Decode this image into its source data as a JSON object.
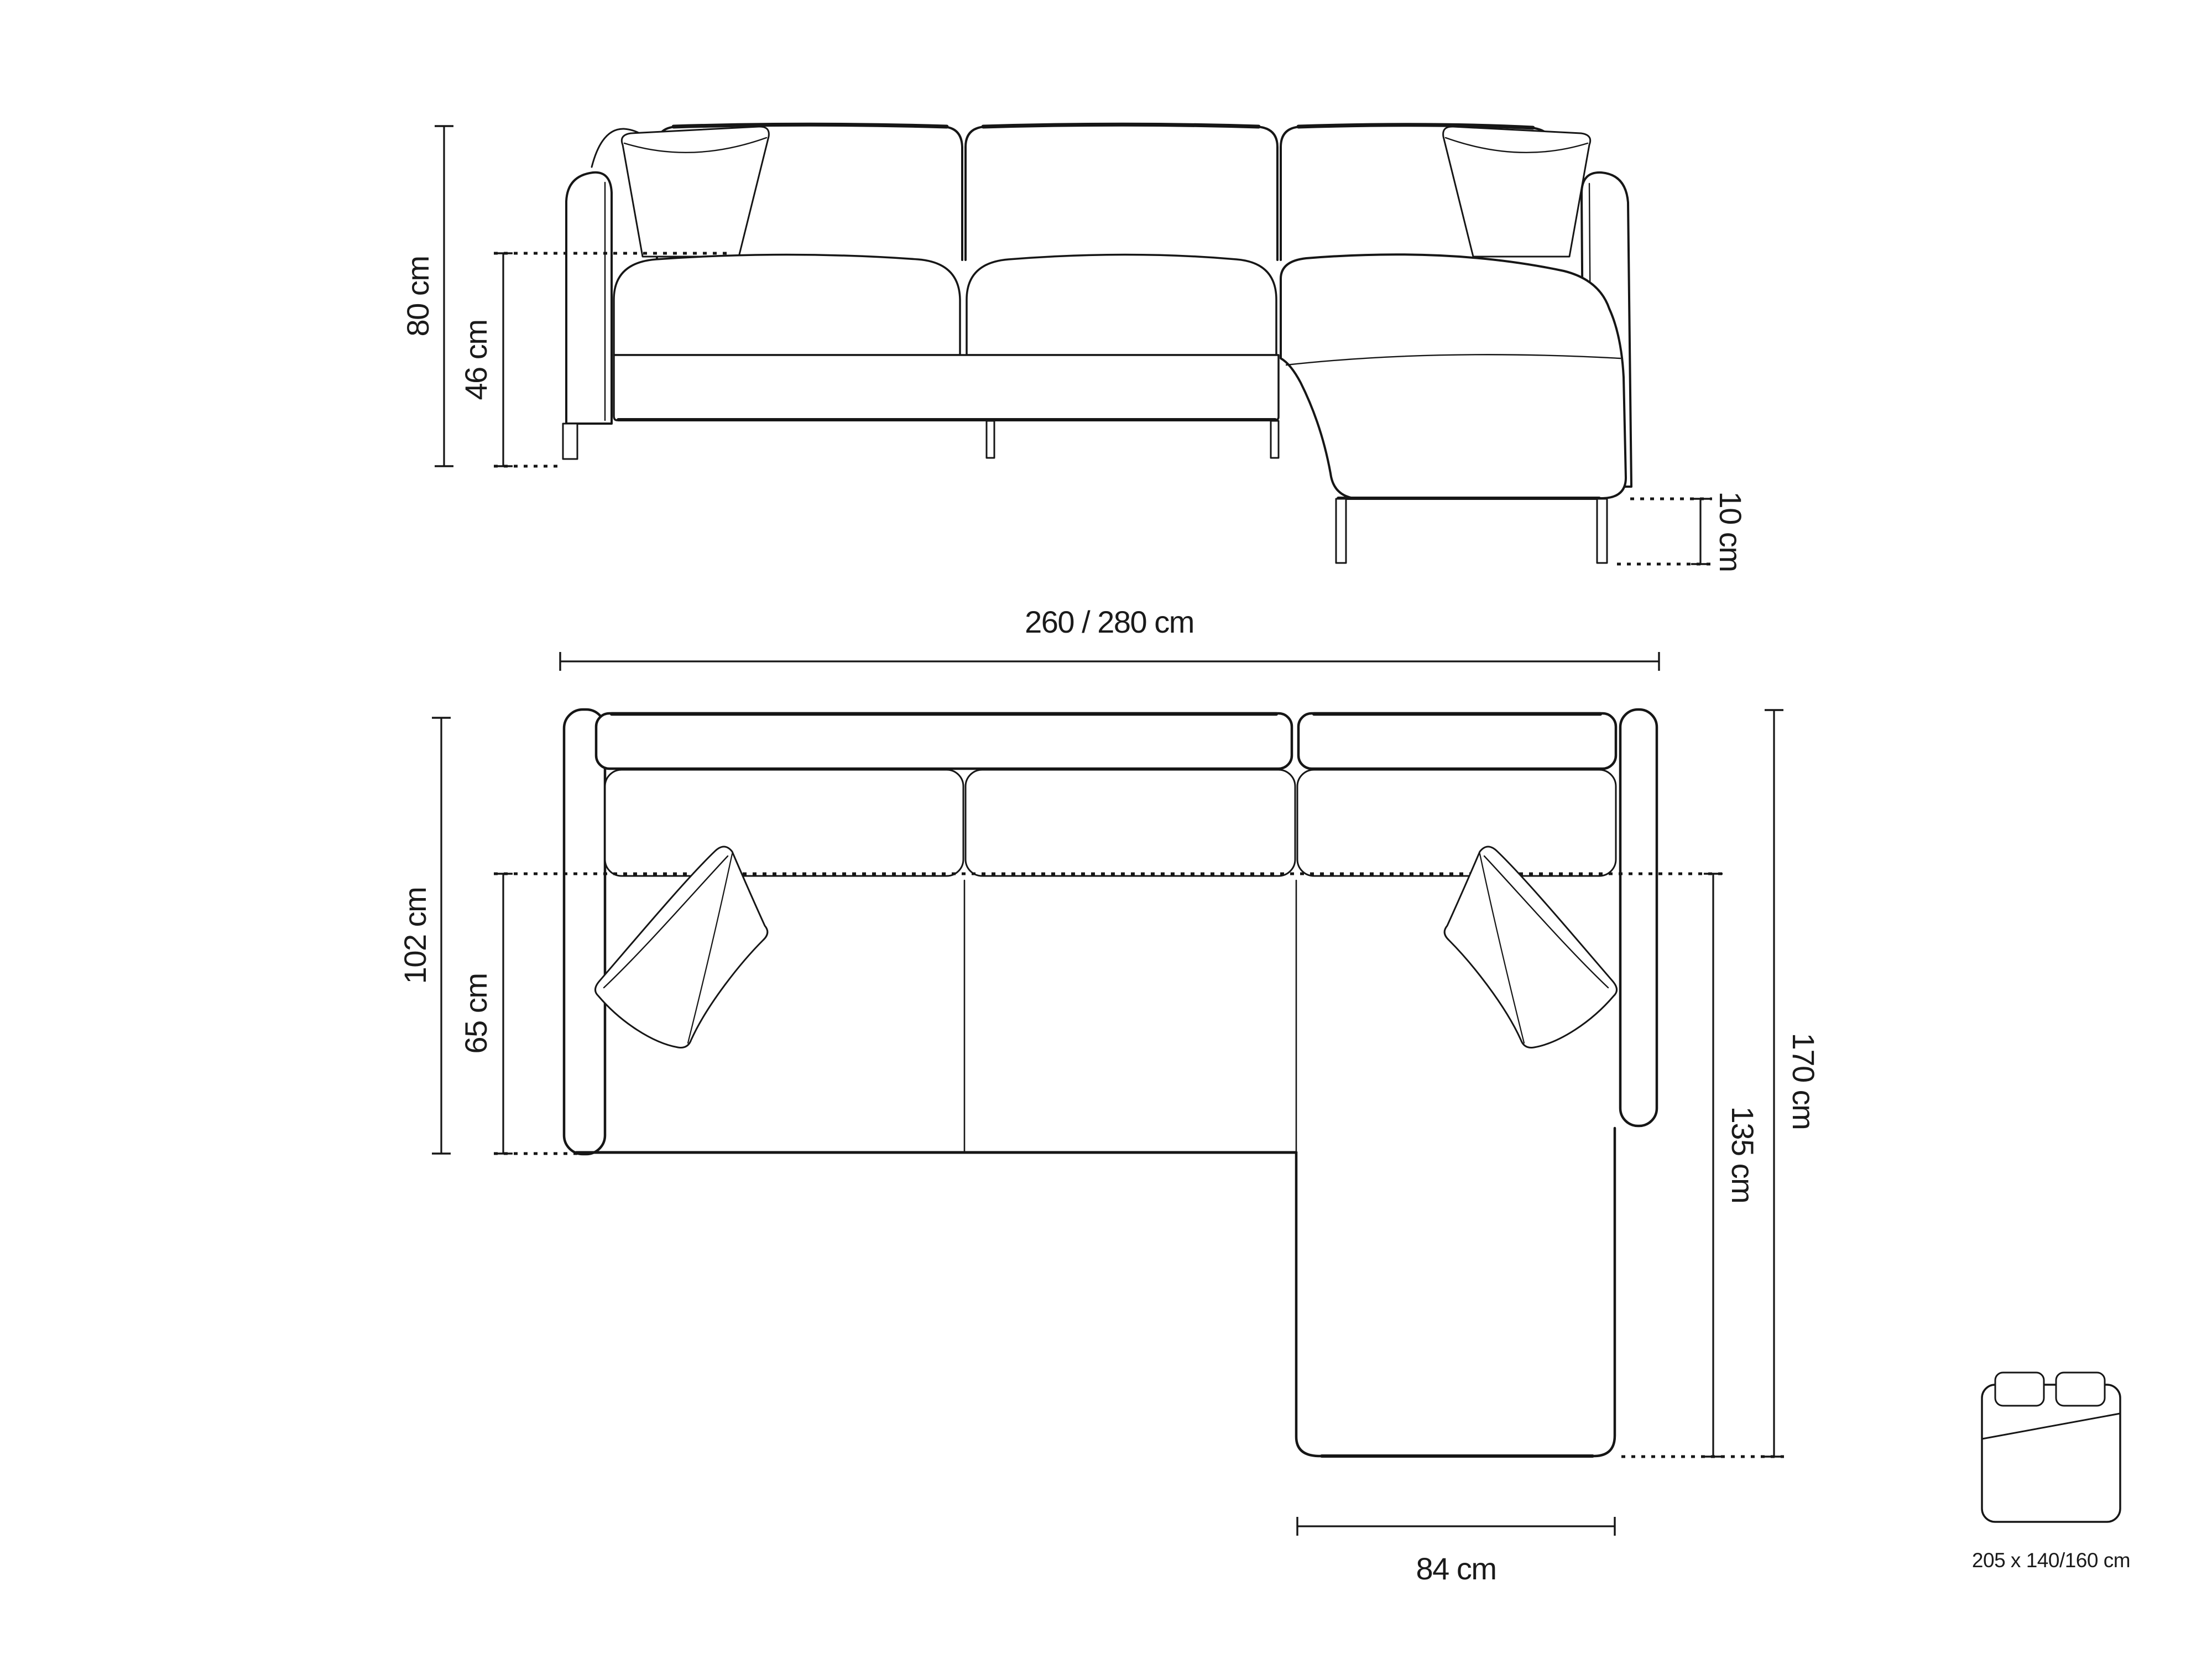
{
  "page": {
    "background_color": "#ffffff",
    "line_color": "#161616",
    "description_icons": {
      "bed_icon": "sleeping-area-bed-top-view"
    }
  },
  "dimensions": {
    "front_total_height": "80 cm",
    "front_seat_height": "46 cm",
    "front_leg_height": "10 cm",
    "total_width": "260 / 280 cm",
    "total_depth": "102 cm",
    "seat_depth": "65 cm",
    "chaise_total_depth": "170 cm",
    "chaise_depth": "135 cm",
    "chaise_width": "84 cm",
    "sleeping_area": "205 x 140/160 cm"
  }
}
